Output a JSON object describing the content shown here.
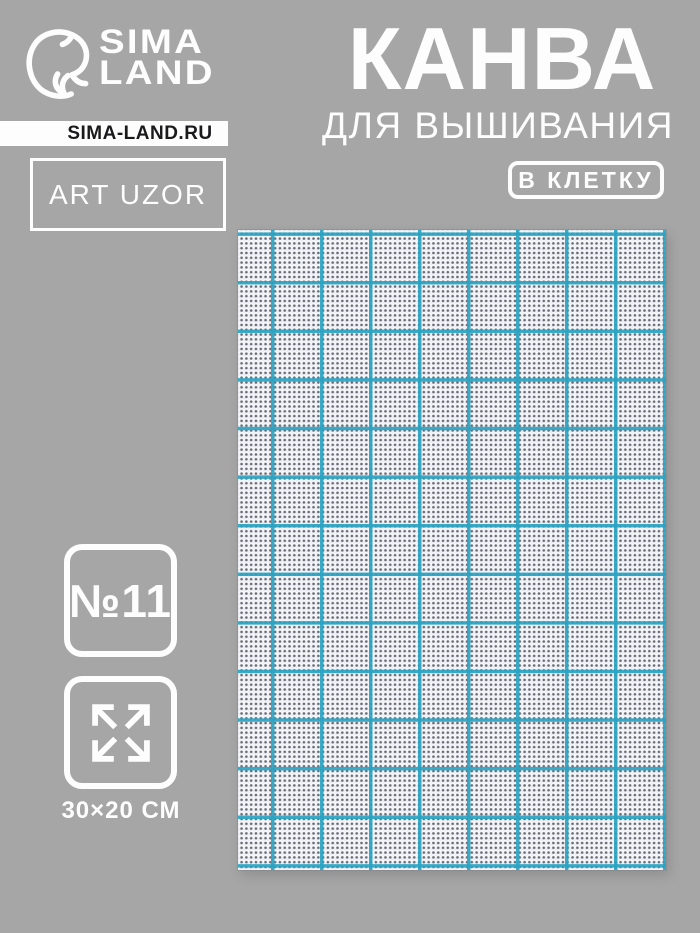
{
  "brand": {
    "logo_line1": "SIMA",
    "logo_line2": "LAND",
    "website": "SIMA-LAND.RU",
    "trademark": "ART UZOR"
  },
  "title": {
    "main": "КАНВА",
    "subtitle": "ДЛЯ ВЫШИВАНИЯ",
    "badge": "В КЛЕТКУ"
  },
  "specs": {
    "count_label": "№11",
    "size_label": "30×20 СМ"
  },
  "icons": {
    "dolphin": "sima-land-dolphin-icon",
    "expand": "expand-arrows-icon"
  },
  "colors": {
    "background": "#a6a6a6",
    "white": "#fdfdfd",
    "dark_text": "#1a1a1c",
    "grid_teal": "#2aa3c2",
    "fabric_base": "#eef0f5"
  },
  "photo": {
    "description": "white aida embroidery canvas with teal square grid",
    "grid_cell_px": 49
  }
}
